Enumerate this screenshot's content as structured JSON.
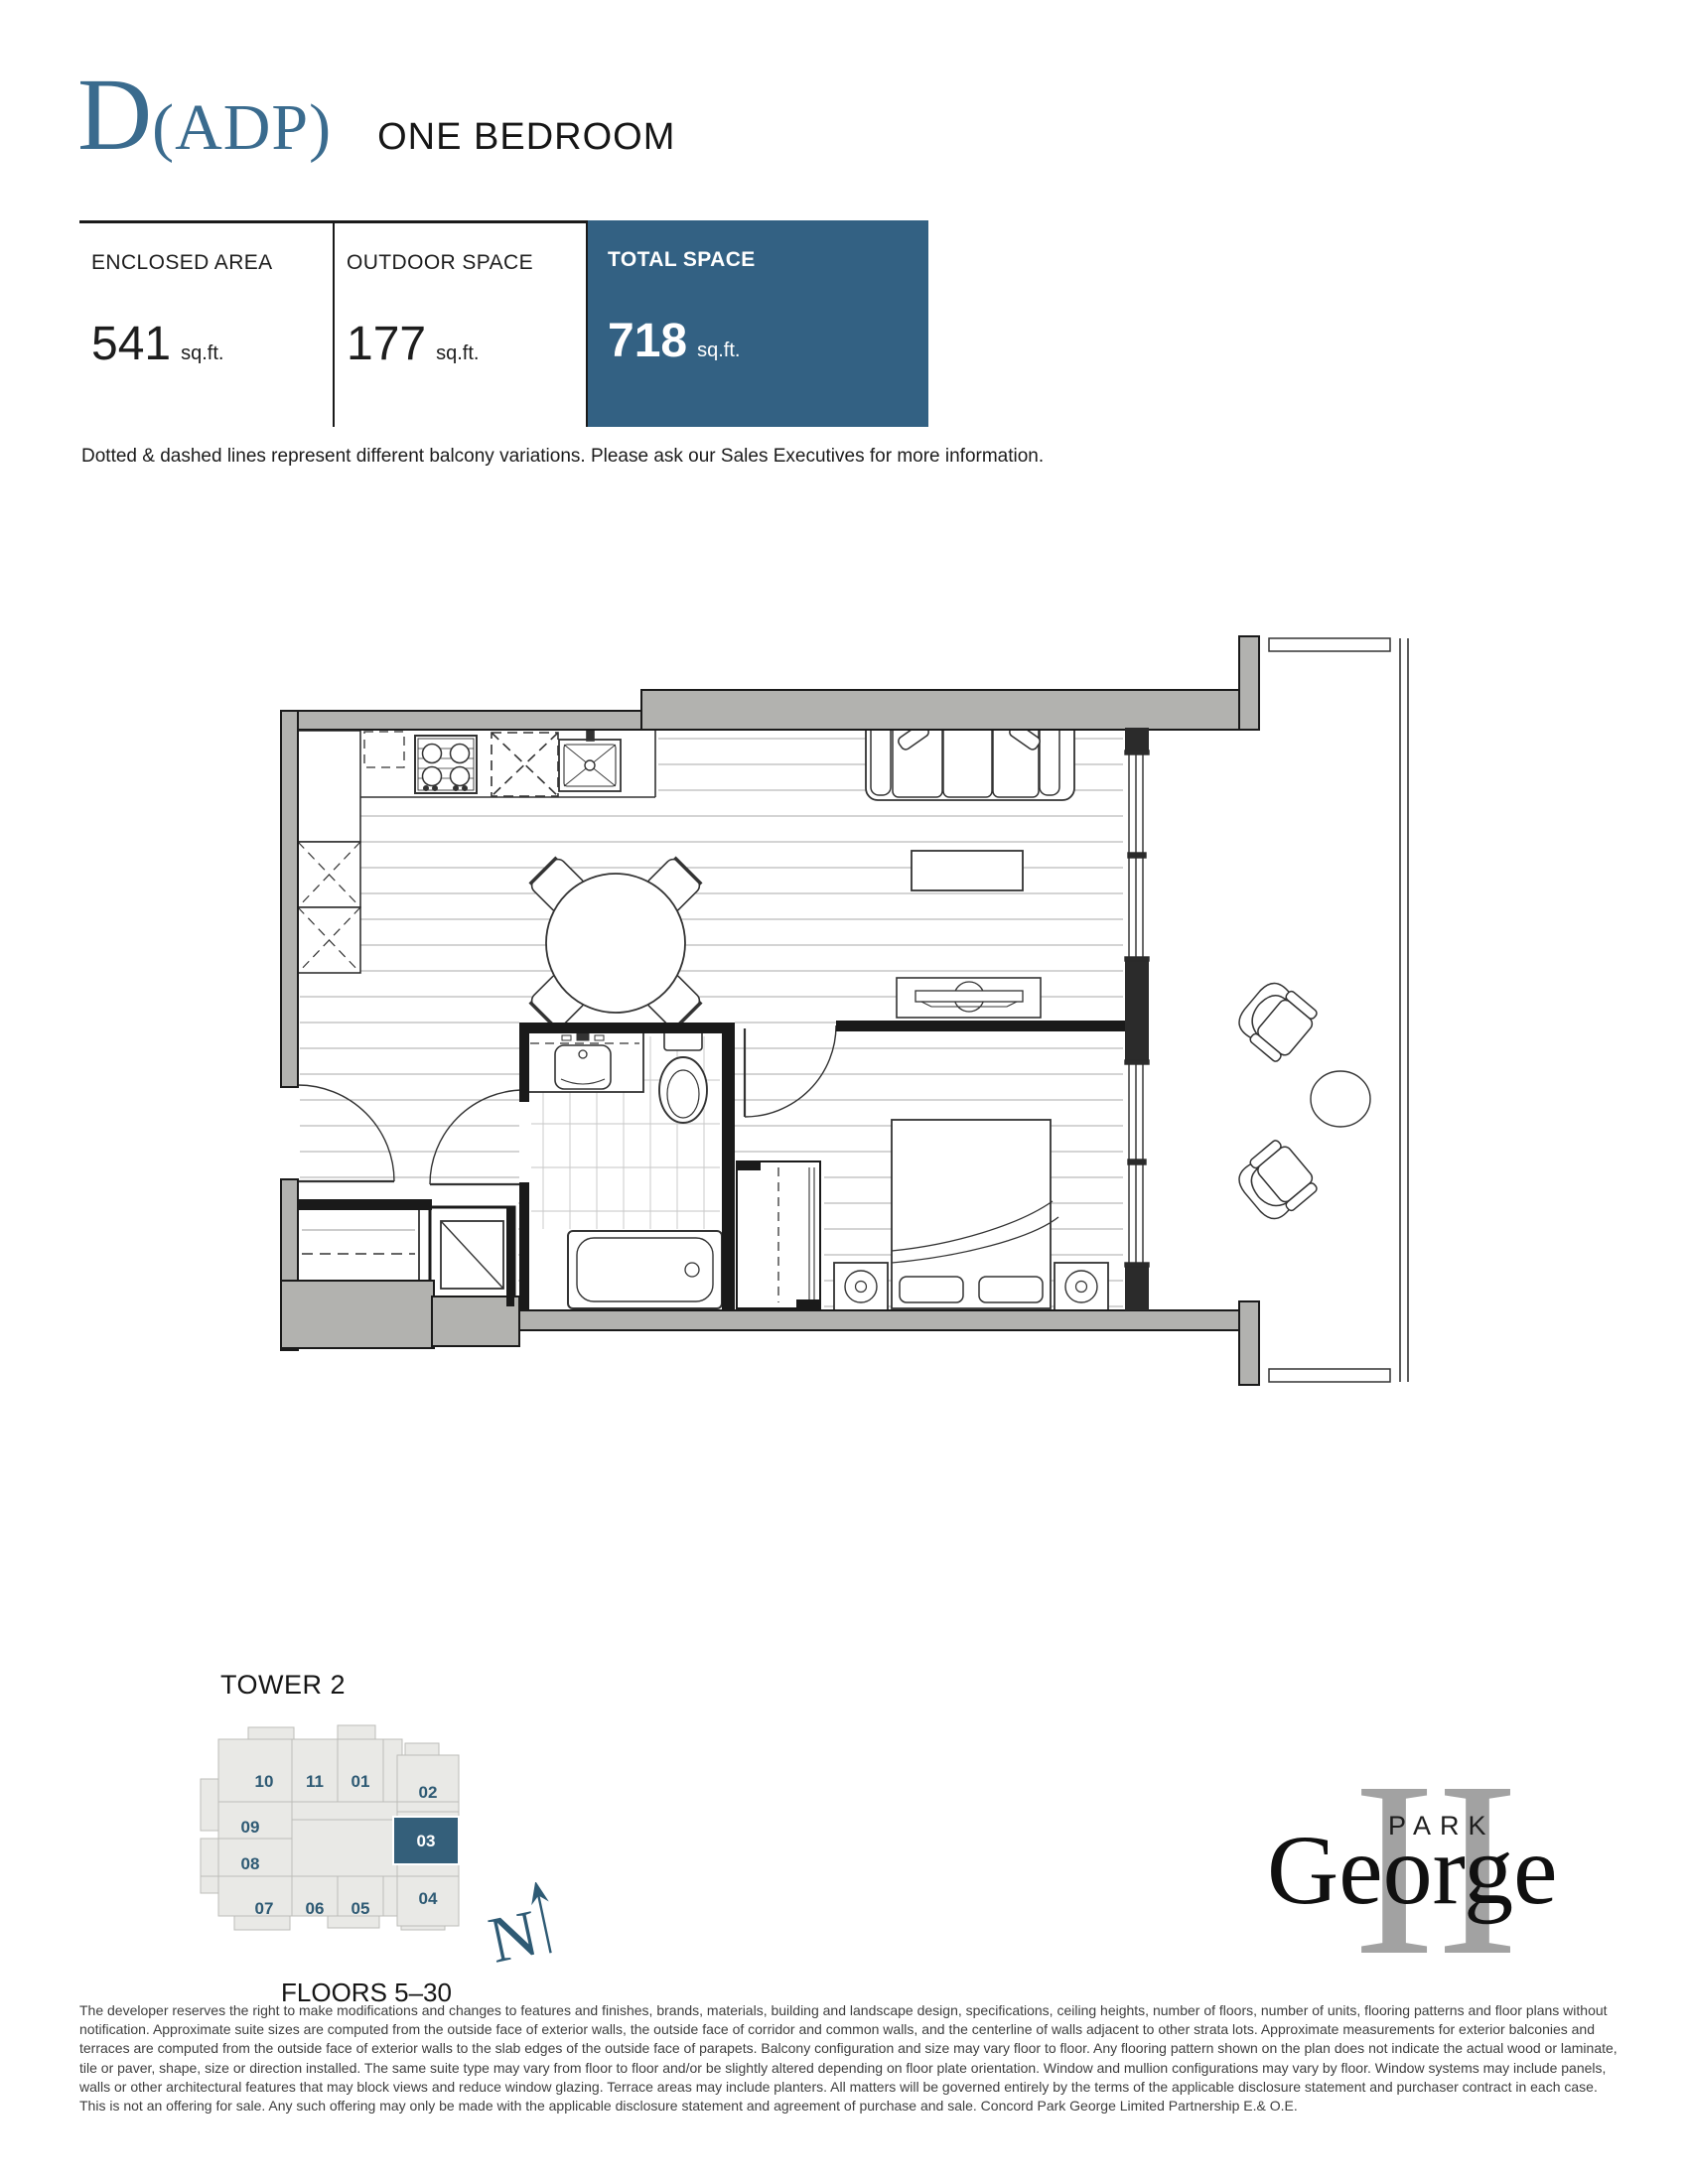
{
  "header": {
    "plan_letter": "D",
    "plan_suffix": "(ADP)",
    "plan_type": "ONE BEDROOM"
  },
  "stats": {
    "columns": [
      {
        "label": "ENCLOSED AREA",
        "value": "541",
        "unit": "sq.ft."
      },
      {
        "label": "OUTDOOR SPACE",
        "value": "177",
        "unit": "sq.ft."
      },
      {
        "label": "TOTAL SPACE",
        "value": "718",
        "unit": "sq.ft."
      }
    ]
  },
  "note": "Dotted & dashed lines represent different balcony variations. Please ask our Sales Executives for more information.",
  "tower": {
    "title": "TOWER 2",
    "floors": "FLOORS 5–30",
    "compass": "N",
    "highlighted_unit": "03",
    "units": [
      {
        "label": "10"
      },
      {
        "label": "11"
      },
      {
        "label": "01"
      },
      {
        "label": "02"
      },
      {
        "label": "09"
      },
      {
        "label": "08"
      },
      {
        "label": "03"
      },
      {
        "label": "07"
      },
      {
        "label": "06"
      },
      {
        "label": "05"
      },
      {
        "label": "04"
      }
    ]
  },
  "logo": {
    "numeral": "II",
    "line1": "PARK",
    "line2": "George"
  },
  "disclaimer": "The developer reserves the right to make modifications and changes to features and finishes, brands, materials, building and landscape design, specifications, ceiling heights, number of floors, number of units, flooring patterns and floor plans without notification. Approximate suite sizes are computed from the outside face of exterior walls, the outside face of corridor and common walls, and the centerline of walls adjacent to other strata lots. Approximate measurements for exterior balconies and terraces are computed from the outside face of exterior walls to the slab edges of the outside face of parapets. Balcony configuration and size may vary floor to floor. Any flooring pattern shown on the plan does not indicate the actual wood or laminate, tile or paver, shape, size or direction installed. The same suite type may vary from floor to floor and/or be slightly altered depending on floor plate orientation. Window and mullion configurations may vary by floor. Window systems may include panels, walls or other architectural features that may block views and reduce window glazing. Terrace areas may include planters. All matters will be governed entirely by the terms of the applicable disclosure statement and purchaser contract in each case. This is not an offering for sale. Any such offering may only be made with the applicable disclosure statement and agreement of purchase and sale. Concord Park George Limited Partnership E.& O.E.",
  "colors": {
    "accent": "#3a6b8e",
    "total_space_block": "#336183",
    "keyplan_highlight": "#345f7a",
    "unit_number": "#2e5a74",
    "wall_gray": "#b2b2af",
    "keyplan_gray": "#e9e9e6"
  }
}
